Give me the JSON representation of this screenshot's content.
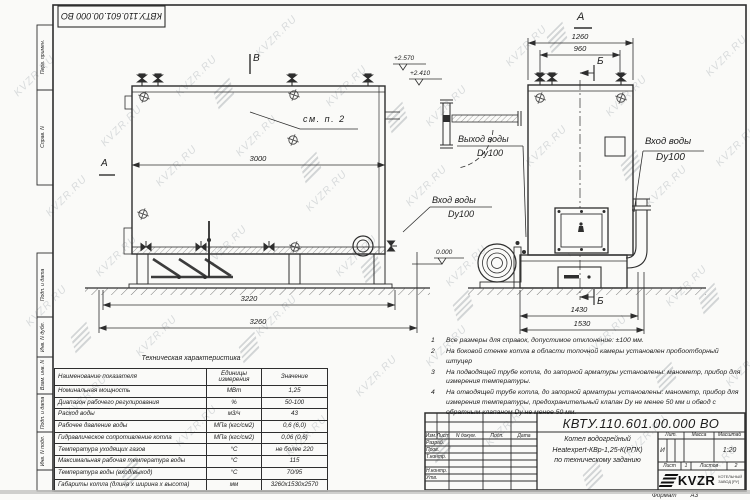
{
  "watermark": {
    "text": "KVZR.RU"
  },
  "frame": {
    "labels": [
      "Перв. примен.",
      "Справ. N",
      "Подп. и дата",
      "Инв. N дубл.",
      "Взам. инв. N",
      "Подп. и дата",
      "Инв. N подл."
    ]
  },
  "views": {
    "side": {
      "label_b": "В",
      "label_a": "А",
      "see_note": "см. п. 2",
      "dim_inner": "3000",
      "dim_skid": "3220",
      "dim_total": "3260",
      "elev_top": "+2.570",
      "elev_mid": "+2.410",
      "elev_zero": "0.000",
      "inlet": {
        "line1": "Вход воды",
        "line2": "Dy100"
      },
      "outlet": {
        "line1": "Выход воды",
        "line2": "Dy100"
      }
    },
    "front": {
      "label_a": "А",
      "marker_b": "Б",
      "dim_top_outer": "1260",
      "dim_top_inner": "960",
      "dim_bottom_inner": "1430",
      "dim_bottom_outer": "1530",
      "inlet": {
        "line1": "Вход воды",
        "line2": "Dy100"
      }
    }
  },
  "notes": {
    "items": [
      {
        "num": "1",
        "text": "Все размеры для справок, допустимое отклонение: ±100 мм."
      },
      {
        "num": "2",
        "text": "На боковой стенке котла в области топочной камеры установлен пробоотборный штуцер"
      },
      {
        "num": "3",
        "text": "На подводящей трубе котла, до запорной арматуры установлены: манометр, прибор для измерения температуры."
      },
      {
        "num": "4",
        "text": "На отводящей трубе котла, до запорной арматуры установлены: манометр, прибор для измерения температуры, предохранительный клапан Dу не менее 50 мм и обвод с обратным клапаном Dу не менее 50 мм."
      }
    ]
  },
  "tech_table": {
    "title": "Техническая характеристика",
    "headers": {
      "name": "Наименование показателя",
      "units": "Единицы измерения",
      "value": "Значение"
    },
    "rows": [
      {
        "name": "Номинальная мощность",
        "units": "МВт",
        "value": "1,25"
      },
      {
        "name": "Диапазон рабочего регулирования",
        "units": "%",
        "value": "50-100"
      },
      {
        "name": "Расход воды",
        "units": "м3/ч",
        "value": "43"
      },
      {
        "name": "Рабочее давление воды",
        "units": "МПа (кгс/см2)",
        "value": "0,6 (6,0)"
      },
      {
        "name": "Гидравлическое сопротивление котла",
        "units": "МПа (кгс/см2)",
        "value": "0,06 (0,6)"
      },
      {
        "name": "Температура уходящих газов",
        "units": "°С",
        "value": "не более 220"
      },
      {
        "name": "Максимальная рабочая температура воды",
        "units": "°С",
        "value": "115"
      },
      {
        "name": "Температура воды (вход/выход)",
        "units": "°С",
        "value": "70/95"
      },
      {
        "name": "Габариты котла (длина х ширина х высота)",
        "units": "мм",
        "value": "3260х1530х2570"
      }
    ]
  },
  "title_block": {
    "doc_number": "КВТУ.110.601.00.000 ВО",
    "cols": {
      "izm": "Изм.",
      "list": "Лист",
      "doc": "N докум.",
      "sign": "Подп.",
      "date": "Дата"
    },
    "roles": {
      "developed": "Разраб.",
      "checked": "Пров.",
      "tcontrol": "Т.контр.",
      "ncontrol": "Н.контр.",
      "approved": "Утв."
    },
    "name_lines": [
      "Котел водогрейный",
      "Heatexpert-КВр-1,25-К(РПК)",
      "по техническому заданию"
    ],
    "lit": {
      "header": "Лит.",
      "value": "И"
    },
    "mass": {
      "header": "Масса"
    },
    "scale": {
      "header": "Масштаб",
      "value": "1:20"
    },
    "sheet": {
      "label": "Лист",
      "value": "1"
    },
    "sheets": {
      "label": "Листов",
      "value": "2"
    },
    "company": {
      "logo": "KVZR",
      "sub1": "КОТЕЛЬНЫЙ",
      "sub2": "ЗАВОД [РУ]"
    },
    "format": {
      "label": "Формат",
      "value": "А3"
    }
  }
}
